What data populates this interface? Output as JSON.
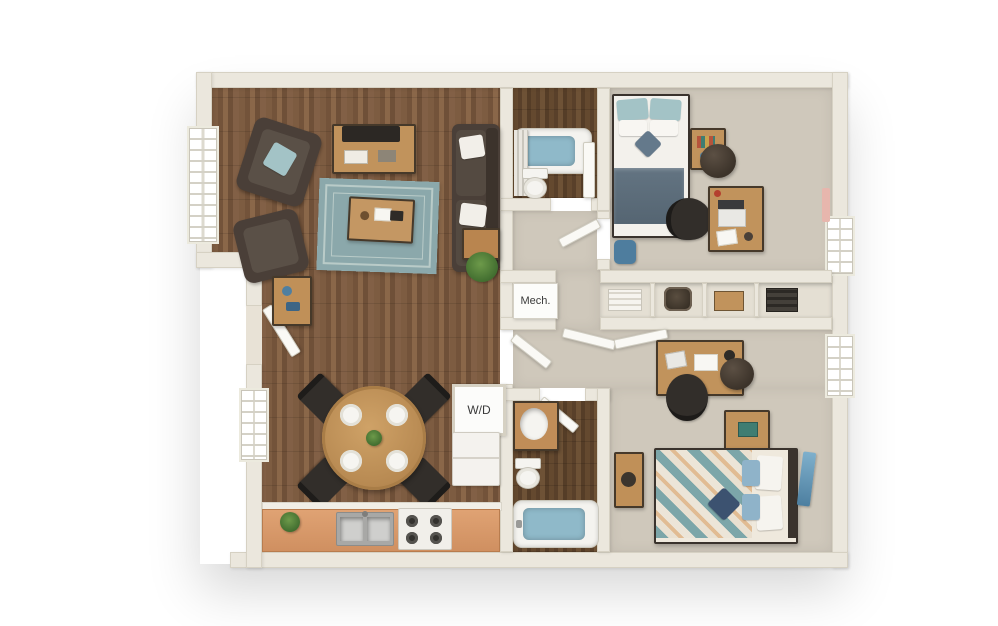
{
  "labels": {
    "mechanical_closet": "Mech.",
    "washer_dryer": "W/D"
  },
  "colors": {
    "wall": "#ebe7dd",
    "wall_edge": "#d6d1c3",
    "carpet": "#cfc8bb",
    "counter": "#d9996b",
    "rug": "#8ba8ab",
    "rug_line": "#b9cbc8",
    "water": "#8fb9c9",
    "sofa": "#4a3f38",
    "furn_wood": "#c1935c",
    "accent_blue": "#a3c3c6",
    "slate": "#5d6e7e",
    "navy": "#3c5270",
    "teal": "#6fa3a8",
    "white_goods": "#f4f2ee",
    "dark_frame": "#3a332d",
    "chair_black": "#2b2927",
    "plant_green": "#4f7a3a"
  },
  "floorplan": {
    "view": "top-down 3d apartment floor plan",
    "rooms": [
      {
        "name": "living-room",
        "floor": "dark hardwood",
        "furniture": [
          "media-console-with-tv",
          "armchair",
          "armchair",
          "area-rug",
          "coffee-table",
          "sofa-with-pillows",
          "side-table",
          "floor-plant",
          "entry-console"
        ]
      },
      {
        "name": "dining-area",
        "floor": "dark hardwood",
        "furniture": [
          "round-dining-table",
          "four-chairs",
          "four-place-settings",
          "centerpiece-plant"
        ]
      },
      {
        "name": "kitchen",
        "floor": "dark hardwood",
        "furniture": [
          "l-shaped-counter",
          "double-sink",
          "range-with-burners",
          "refrigerator",
          "stacked-washer-dryer-closet",
          "counter-plant"
        ]
      },
      {
        "name": "bathroom-1",
        "floor": "dark wood tile",
        "furniture": [
          "bathtub",
          "shower-curtain",
          "toilet",
          "open-door"
        ]
      },
      {
        "name": "bedroom-1",
        "floor": "carpet",
        "furniture": [
          "bed-blue-pillows-slate-blanket",
          "nightstand-with-books",
          "round-pouf",
          "desk-with-laptop",
          "office-chair",
          "duffel-bag",
          "window",
          "wall-art"
        ]
      },
      {
        "name": "hallway",
        "floor": "carpet",
        "furniture": [
          "open-door"
        ]
      },
      {
        "name": "storage-closets",
        "floor": "shelving",
        "furniture": [
          "mechanical-closet",
          "linen-stack",
          "woven-basket",
          "storage-box",
          "book-stacks"
        ]
      },
      {
        "name": "bathroom-2",
        "floor": "dark wood tile",
        "furniture": [
          "vanity-sink",
          "toilet",
          "bathtub",
          "open-door"
        ]
      },
      {
        "name": "bedroom-2",
        "floor": "carpet",
        "furniture": [
          "desk-with-laptop",
          "office-chair",
          "round-pouf",
          "nightstand-with-book",
          "bed-patterned-comforter",
          "leaning-art",
          "wood-bench",
          "bifold-closet-doors",
          "window"
        ]
      }
    ]
  }
}
